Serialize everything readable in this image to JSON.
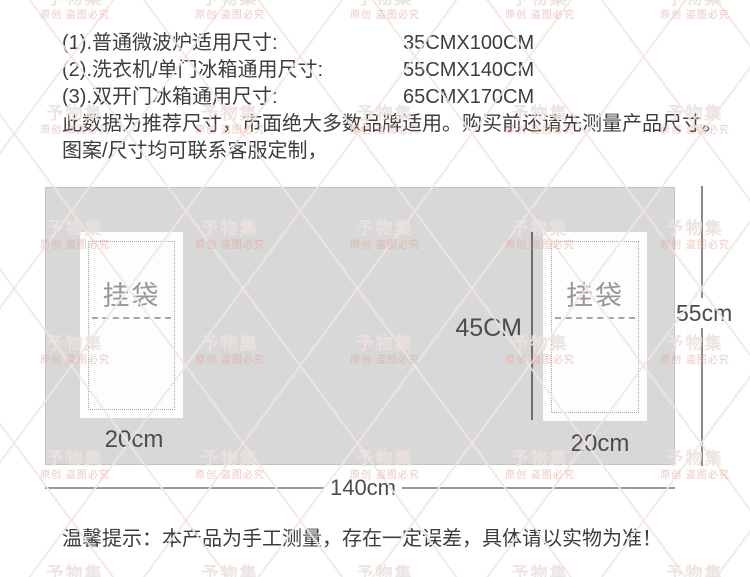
{
  "spec": {
    "rows": [
      {
        "label": "(1).普通微波炉适用尺寸:",
        "value": "35CMX100CM"
      },
      {
        "label": "(2).洗衣机/单门冰箱通用尺寸:",
        "value": "55CMX140CM"
      },
      {
        "label": "(3).双开门冰箱通用尺寸:",
        "value": "65CMX170CM"
      }
    ],
    "note_line1": "此数据为推荐尺寸，市面绝大多数品牌适用。购买前还请先测量产品尺寸。",
    "note_line2": "图案/尺寸均可联系客服定制，"
  },
  "diagram": {
    "pocket_label": "挂袋",
    "inner_height_label": "45CM",
    "total_height_label": "55cm",
    "pocket_width_label": "20cm",
    "total_width_label": "140cm",
    "panel_color": "#d8d8d8"
  },
  "footer": {
    "note": "温馨提示：本产品为手工测量，存在一定误差，具体请以实物为准！"
  },
  "watermark": {
    "brand": "予物集",
    "slogan": "原创 盗图必究",
    "brand_color": "rgba(236,226,222,0.92)",
    "slogan_color": "rgba(224,164,152,0.60)"
  }
}
